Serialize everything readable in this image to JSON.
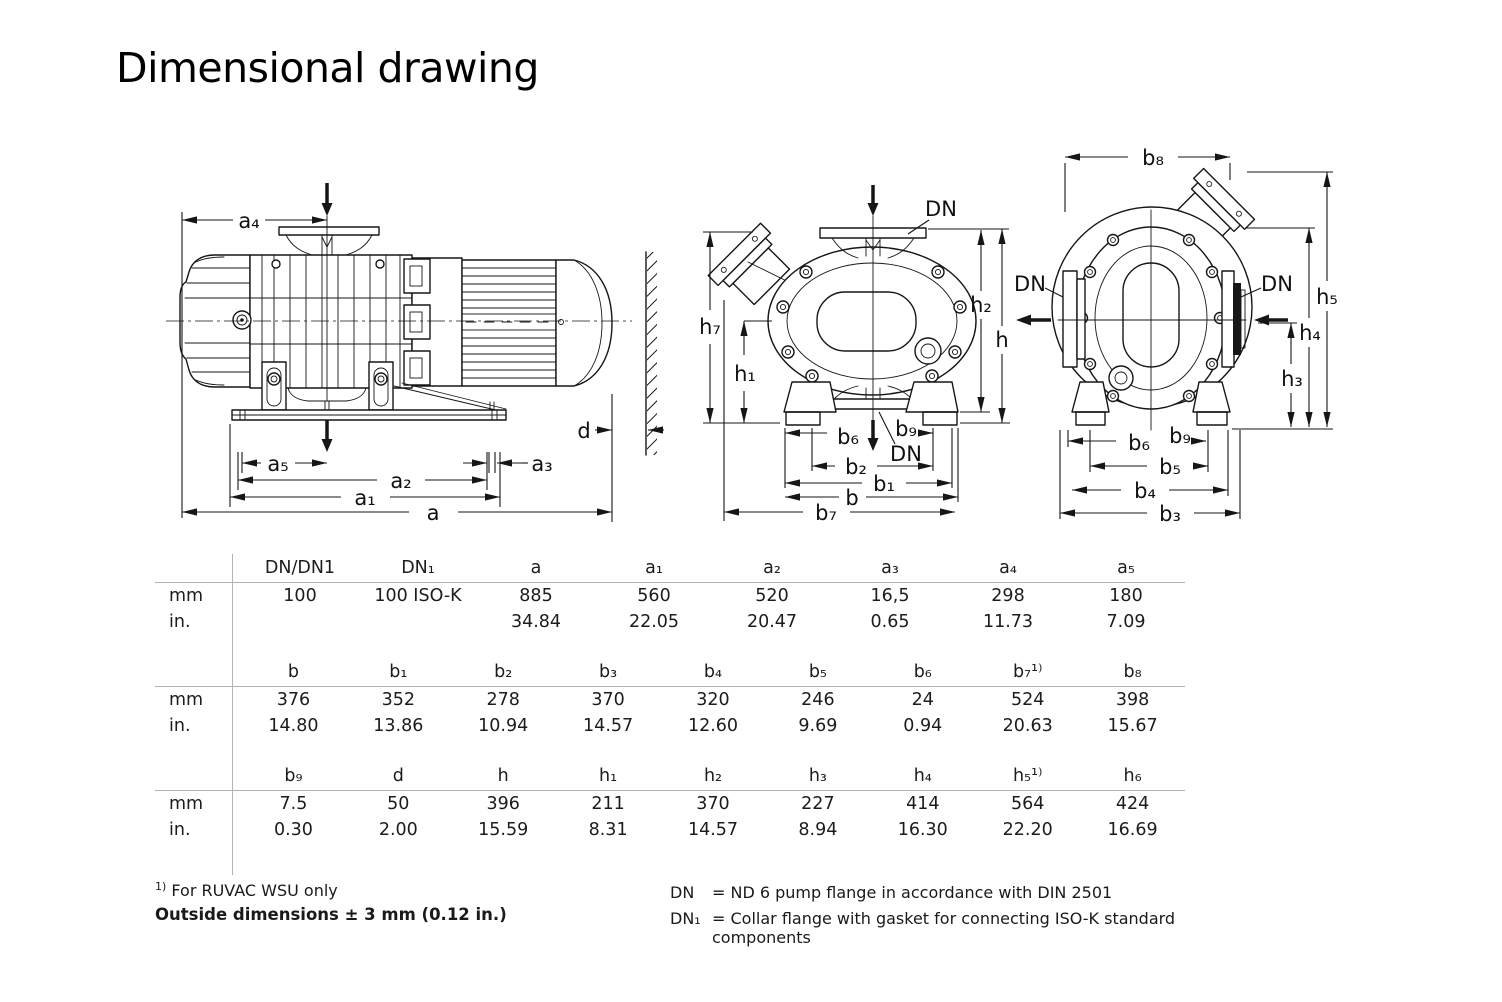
{
  "title": "Dimensional drawing",
  "labels": {
    "a": "a",
    "a1": "a₁",
    "a2": "a₂",
    "a3": "a₃",
    "a4": "a₄",
    "a5": "a₅",
    "b": "b",
    "b1": "b₁",
    "b2": "b₂",
    "b3": "b₃",
    "b4": "b₄",
    "b5": "b₅",
    "b6": "b₆",
    "b7": "b₇",
    "b8": "b₈",
    "b9": "b₉",
    "d": "d",
    "h": "h",
    "h1": "h₁",
    "h2": "h₂",
    "h3": "h₃",
    "h4": "h₄",
    "h5": "h₅",
    "h7": "h₇",
    "dn": "DN"
  },
  "units": {
    "mm": "mm",
    "in": "in."
  },
  "tables": [
    {
      "headers": [
        "DN/DN1",
        "DN₁",
        "a",
        "a₁",
        "a₂",
        "a₃",
        "a₄",
        "a₅"
      ],
      "mm": [
        "100",
        "100 ISO-K",
        "885",
        "560",
        "520",
        "16,5",
        "298",
        "180"
      ],
      "in": [
        "",
        "",
        "34.84",
        "22.05",
        "20.47",
        "0.65",
        "11.73",
        "7.09"
      ]
    },
    {
      "headers": [
        "b",
        "b₁",
        "b₂",
        "b₃",
        "b₄",
        "b₅",
        "b₆",
        "b₇¹⁾",
        "b₈"
      ],
      "mm": [
        "376",
        "352",
        "278",
        "370",
        "320",
        "246",
        "24",
        "524",
        "398"
      ],
      "in": [
        "14.80",
        "13.86",
        "10.94",
        "14.57",
        "12.60",
        "9.69",
        "0.94",
        "20.63",
        "15.67"
      ]
    },
    {
      "headers": [
        "b₉",
        "d",
        "h",
        "h₁",
        "h₂",
        "h₃",
        "h₄",
        "h₅¹⁾",
        "h₆"
      ],
      "mm": [
        "7.5",
        "50",
        "396",
        "211",
        "370",
        "227",
        "414",
        "564",
        "424"
      ],
      "in": [
        "0.30",
        "2.00",
        "15.59",
        "8.31",
        "14.57",
        "8.94",
        "16.30",
        "22.20",
        "16.69"
      ]
    }
  ],
  "footnotes": {
    "marker": "1)",
    "note": "For RUVAC WSU only",
    "tolerance": "Outside dimensions ± 3 mm (0.12 in.)",
    "dn_term": "DN",
    "dn_def": "= ND 6 pump flange in accordance with DIN 2501",
    "dn1_term": "DN₁",
    "dn1_def": "= Collar flange with gasket for connecting ISO-K standard components"
  }
}
